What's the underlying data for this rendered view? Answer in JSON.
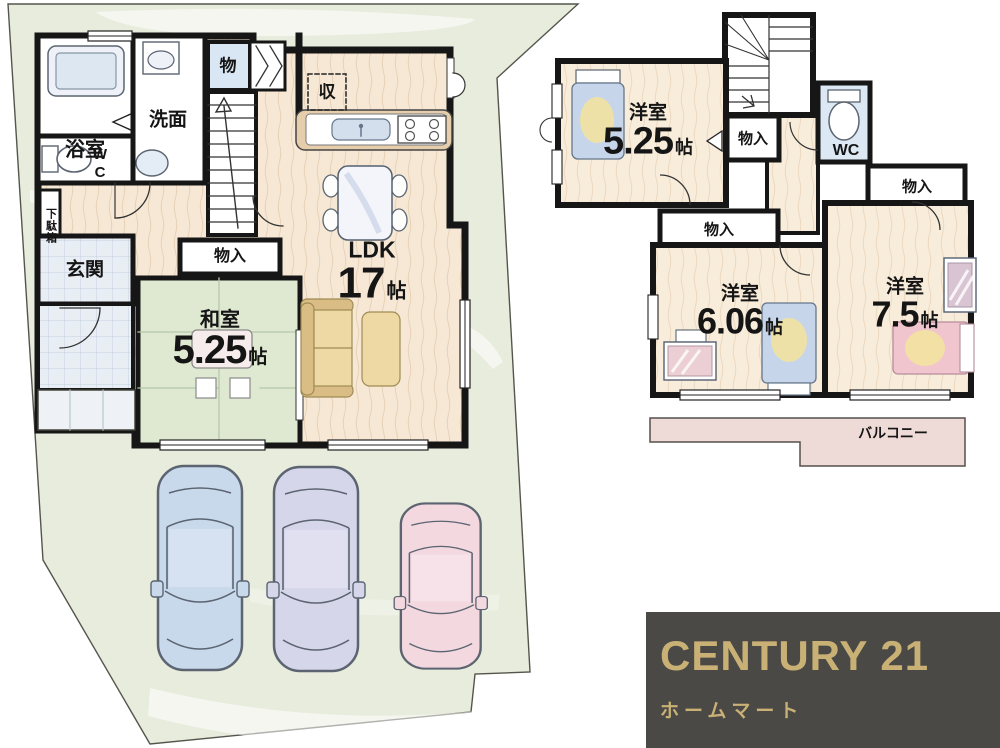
{
  "floor1": {
    "rooms": {
      "bath": {
        "label": "浴室"
      },
      "washroom": {
        "label": "洗面"
      },
      "wc": {
        "label": "WC"
      },
      "storage_small": {
        "label": "物"
      },
      "shoe_cabinet": {
        "label": "下駄箱"
      },
      "entrance": {
        "label": "玄関"
      },
      "closet": {
        "label": "物入"
      },
      "washitsu": {
        "label": "和室",
        "size": "5.25",
        "unit": "帖"
      },
      "kitchen_storage": {
        "label": "収"
      },
      "ldk": {
        "label": "LDK",
        "size": "17",
        "unit": "帖"
      }
    }
  },
  "floor2": {
    "rooms": {
      "bedroom1": {
        "label": "洋室",
        "size": "5.25",
        "unit": "帖"
      },
      "closet_hall": {
        "label": "物入"
      },
      "wc": {
        "label": "WC"
      },
      "closet_right": {
        "label": "物入"
      },
      "closet_mid": {
        "label": "物入"
      },
      "bedroom2": {
        "label": "洋室",
        "size": "6.06",
        "unit": "帖"
      },
      "bedroom3": {
        "label": "洋室",
        "size": "7.5",
        "unit": "帖"
      },
      "balcony": {
        "label": "バルコニー"
      }
    }
  },
  "brand": {
    "name": "CENTURY 21",
    "sub": "ホームマート"
  },
  "colors": {
    "lot": "#e7ecdc",
    "wall": "#161616",
    "wood_floor": "#f6e8d5",
    "tatami": "#dfe9d2",
    "tile": "#e9eef5",
    "balcony": "#eedad6",
    "car_blue": "#c9d9ec",
    "car_lavender": "#d6d6eb",
    "car_pink": "#f3d8e0",
    "brand_bg": "#4b4945",
    "brand_gold": "#c9b176"
  }
}
